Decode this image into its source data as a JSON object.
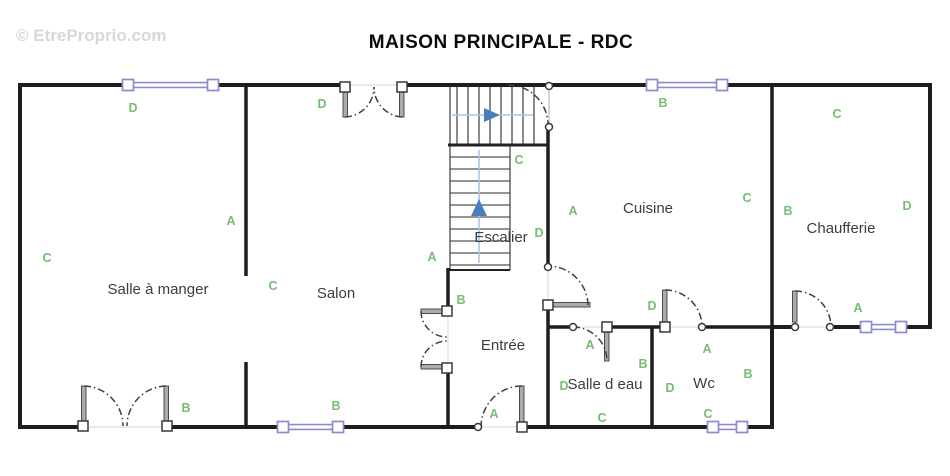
{
  "watermark": "© EtreProprio.com",
  "title": "MAISON PRINCIPALE - RDC",
  "rooms": {
    "salle_a_manger": "Salle à manger",
    "salon": "Salon",
    "escalier": "Escalier",
    "entree": "Entrée",
    "cuisine": "Cuisine",
    "chaufferie": "Chaufferie",
    "salle_d_eau": "Salle d eau",
    "wc": "Wc"
  },
  "wall_labels": [
    "D",
    "A",
    "C",
    "B",
    "D",
    "C",
    "B",
    "A",
    "C",
    "D",
    "B",
    "A",
    "A",
    "B",
    "C",
    "D",
    "A",
    "B",
    "C",
    "D",
    "A",
    "D",
    "B",
    "C",
    "C",
    "B",
    "D",
    "A"
  ],
  "colors": {
    "wall": "#1d1d1d",
    "window": "#8c8ccd",
    "wall_label_green": "#75bc75",
    "room_text": "#3d3d3d",
    "door_leaf": "#ababab",
    "stair_arrow_blue": "#4a7cc0",
    "stair_guide_blue": "#a9c4e6",
    "watermark_gray": "#d7d7d7"
  }
}
